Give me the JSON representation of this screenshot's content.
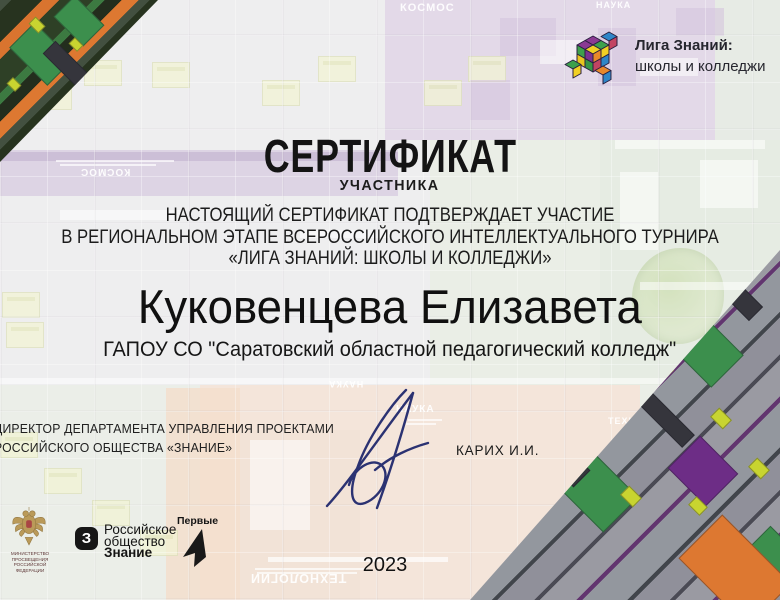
{
  "certificate": {
    "title": "СЕРТИФИКАТ",
    "subtitle": "УЧАСТНИКА",
    "body_lines": [
      "НАСТОЯЩИЙ СЕРТИФИКАТ  ПОДТВЕРЖДАЕТ УЧАСТИЕ",
      "В РЕГИОНАЛЬНОМ ЭТАПЕ ВСЕРОССИЙСКОГО ИНТЕЛЛЕКТУАЛЬНОГО ТУРНИРА",
      "«ЛИГА ЗНАНИЙ: ШКОЛЫ И КОЛЛЕДЖИ»"
    ],
    "recipient_name": "Куковенцева Елизавета",
    "recipient_org": "ГАПОУ СО \"Саратовский областной педагогический колледж\"",
    "year": "2023"
  },
  "league_logo": {
    "line1": "Лига Знаний:",
    "line2": "школы и колледжи"
  },
  "signatory": {
    "title_line1": "ДИРЕКТОР ДЕПАРТАМЕНТА УПРАВЛЕНИЯ ПРОЕКТАМИ",
    "title_line2": "РОССИЙСКОГО ОБЩЕСТВА «ЗНАНИЕ»",
    "name": "КАРИХ И.И."
  },
  "footer": {
    "ministry": {
      "line1": "МИНИСТЕРСТВО ПРОСВЕЩЕНИЯ",
      "line2": "РОССИЙСКОЙ ФЕДЕРАЦИИ"
    },
    "znanie": {
      "icon_letter": "З",
      "line1": "Российское",
      "line2": "общество",
      "line3": "Знание"
    },
    "pervye": {
      "label": "Первые"
    }
  },
  "background_labels": {
    "kosmos_top": "КОСМОС",
    "kosmos_flipped": "КОСМОС",
    "nauka": "НАУКА",
    "nauka_flipped": "НАУКА",
    "nauka_top": "НАУКА",
    "tech_flipped": "ТЕХНОЛОГИИ",
    "tech_right": "ТЕХНОЛ"
  },
  "colors": {
    "ink": "#1a1a1a",
    "signature_ink": "#2b3272",
    "accent_orange": "#dd7831",
    "accent_purple": "#6d2d86",
    "accent_green": "#3c8f4d",
    "accent_yellow": "#c8d430"
  }
}
